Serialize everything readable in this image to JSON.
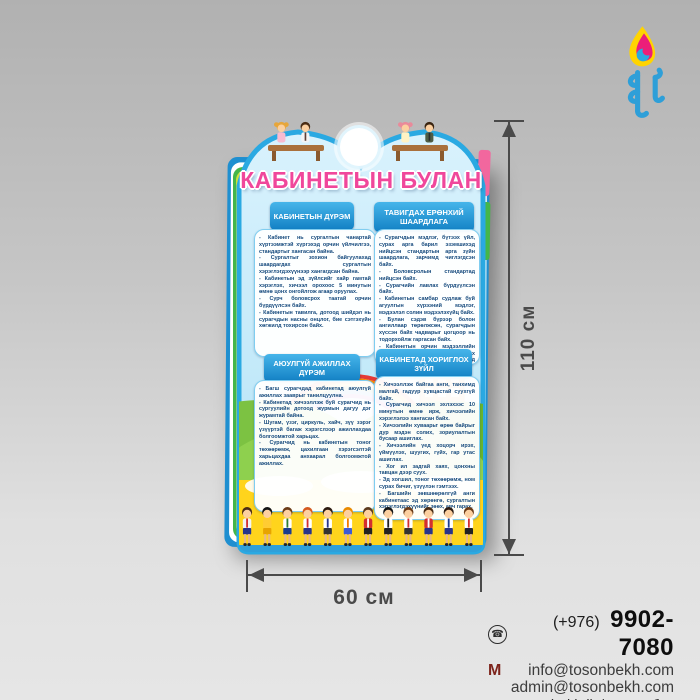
{
  "poster": {
    "title": "КАБИНЕТЫН БУЛАН",
    "title_color": "#f0479b",
    "accent_blue": "#2aa9e2",
    "panels": [
      {
        "header": "КАБИНЕТЫН ДҮРЭМ",
        "body": "- Кабинет нь сургалтын чанартай хүртээмжтэй хүргэхэд орчин үйлчилгээ, стандартыг хангасан байна.\n- Сургалтыг зохион байгуулахад шаардагдах сургалтын хэрэглэгдэхүүнээр хангагдсан байна.\n- Кабинетын эд зүйлсийг хайр гамтай хэрэглэх, хичээл орохоос 5 минутын өмнө цонх онгойлгож агаар оруулах.\n- Сурч боловсрох таатай орчин бүрдүүлсэн байх.\n- Кабинетын тавилга, дотоод шийдэл нь сурагчдын насны онцлог, бие сэтгэхүйн хөгжилд тохирсон байх."
      },
      {
        "header": "ТАВИГДАХ ЕРӨНХИЙ ШААРДЛАГА",
        "body": "- Сурагчдын мэдлэг, бүтээх үйл, сурах арга барил эзэмшихэд нийцсэн стандартын арга зүйн шаардлага, зарчимд чиглэгдсэн байх.\n- Боловсролын стандартад нийцсэн байх.\n- Сурагчийн лавлах бүрдүүлсэн байх.\n- Кабинетын самбар судлаж буй агуулгын хүрээний мэдлэг, мэдээлэл солин мэдээлэхүйц байх.\n- Булан сэдэв бүрээр болон ангиллаар төрөлжсөн, сурагчдын хүссэн байх чадварыг цогцоор нь тодорхойлж гаргасан байх.\n- Кабинетын орчин мэдээллийн агуулга нь сурагчдын эзэмших боловсролд нийцсэн, арга ухаанд сургахад чиглэсэн байх."
      },
      {
        "header": "АЮУЛГҮЙ АЖИЛЛАХ ДҮРЭМ",
        "body": "- Багш сурагчдад кабинетад аюулгүй ажиллах зааврыг танилцуулна.\n- Кабинетад хичээллэж буй сурагчид нь сургуулийн дотоод журмын дагуу дэг журамтай байна.\n- Шугам, үзэг, циркуль, хайч, зүү зэрэг үзүүртэй багаж хэрэгслээр ажиллахдаа болгоомжтой харьцах.\n- Сурагчид нь кабинетын тоног төхөөрөмж, цахилгаан хэрэгсэлтэй харьцахдаа анхаарал болгоомжтой ажиллах."
      },
      {
        "header": "КАБИНЕТАД ХОРИГЛОХ ЗҮЙЛ",
        "body": "- Хичээллэж байгаа анги, танхимд малгай, гадуур хувцастай суухгүй байх.\n- Сурагчид хичээл эхлэхээс 10 минутын өмнө ирж, хичээлийн хэрэглэлээ хангасан байх.\n- Хичээлийн хуваарьт өрөө байрыг дур мэдэн солих, зориулалтын бусаар ашиглах.\n- Хичээлийн үед хоцорч ирэх, үймүүлэх, шуугих, гүйх, гар утас ашиглах.\n- Хог ил задгай хаях, цонхны тавцан дээр суух.\n- Эд хогшил, тоног төхөөрөмж, ном сурах бичиг, үзүүлэн гэмтээх.\n- Багшийн зөвшөөрөлгүй анги кабинетаас эд хөрөнгө, сургалтын хэрэглэгдэхүүнийг зөөх, авч гарах."
      }
    ]
  },
  "dimensions": {
    "height_label": "110 см",
    "width_label": "60 см"
  },
  "contact": {
    "phone_icon": "☎",
    "phone_prefix": "(+976)",
    "phone_number": "9902-7080",
    "gmail_icon": "M",
    "email1": "info@tosonbekh.com",
    "email2": "admin@tosonbekh.com",
    "facebook_icon": "f",
    "company": "Toson bekh llc/ Тосон бэх ХХК"
  }
}
